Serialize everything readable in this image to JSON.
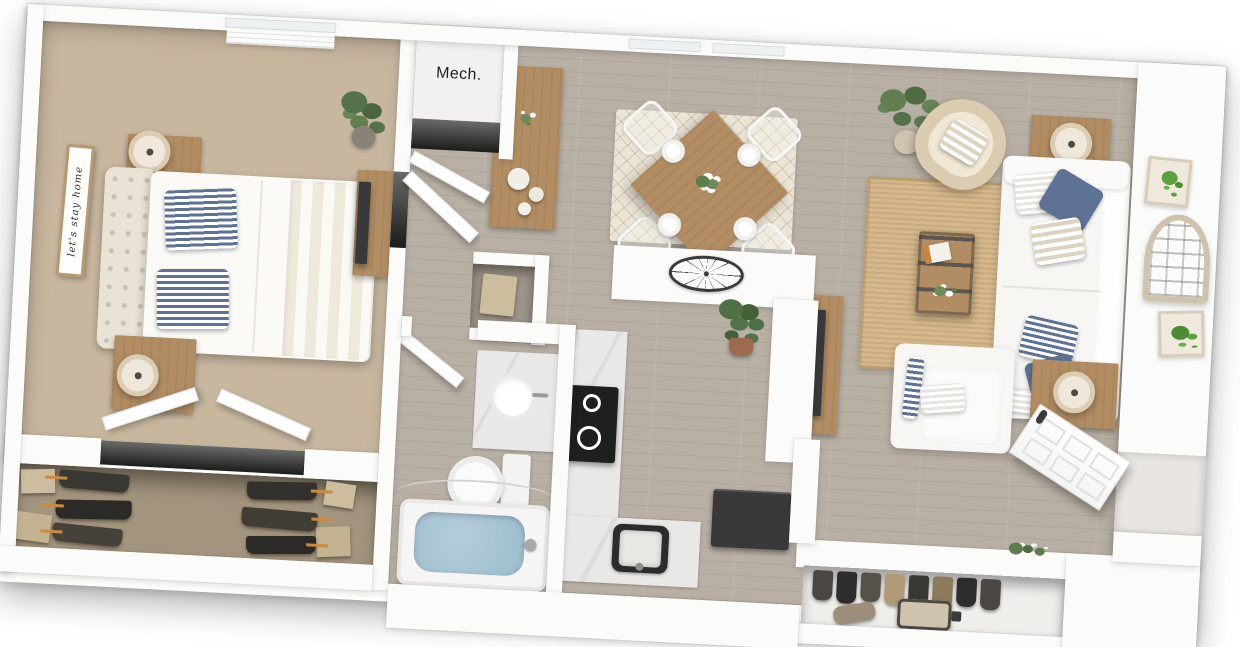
{
  "labels": {
    "mech_closet": "Mech.",
    "bedroom_sign": "let's stay home"
  },
  "palette": {
    "wall": "#fbfbfa",
    "wood_floor": "#b9b0a5",
    "carpet": "#c8b79f",
    "closet_carpet": "#a3947d",
    "marble": "#e9e8e7",
    "jute_rug": "#d5b88c",
    "dining_rug": "#ece5d6",
    "accent_navy": "#5d7294",
    "appliance_dark": "#39393b",
    "wood_furniture": "#b28d63",
    "bath_water": "#9cbccd",
    "plant_green": "#5d7d4e",
    "hanger_orange": "#c98b3f",
    "sign_wood": "#b59a72"
  }
}
